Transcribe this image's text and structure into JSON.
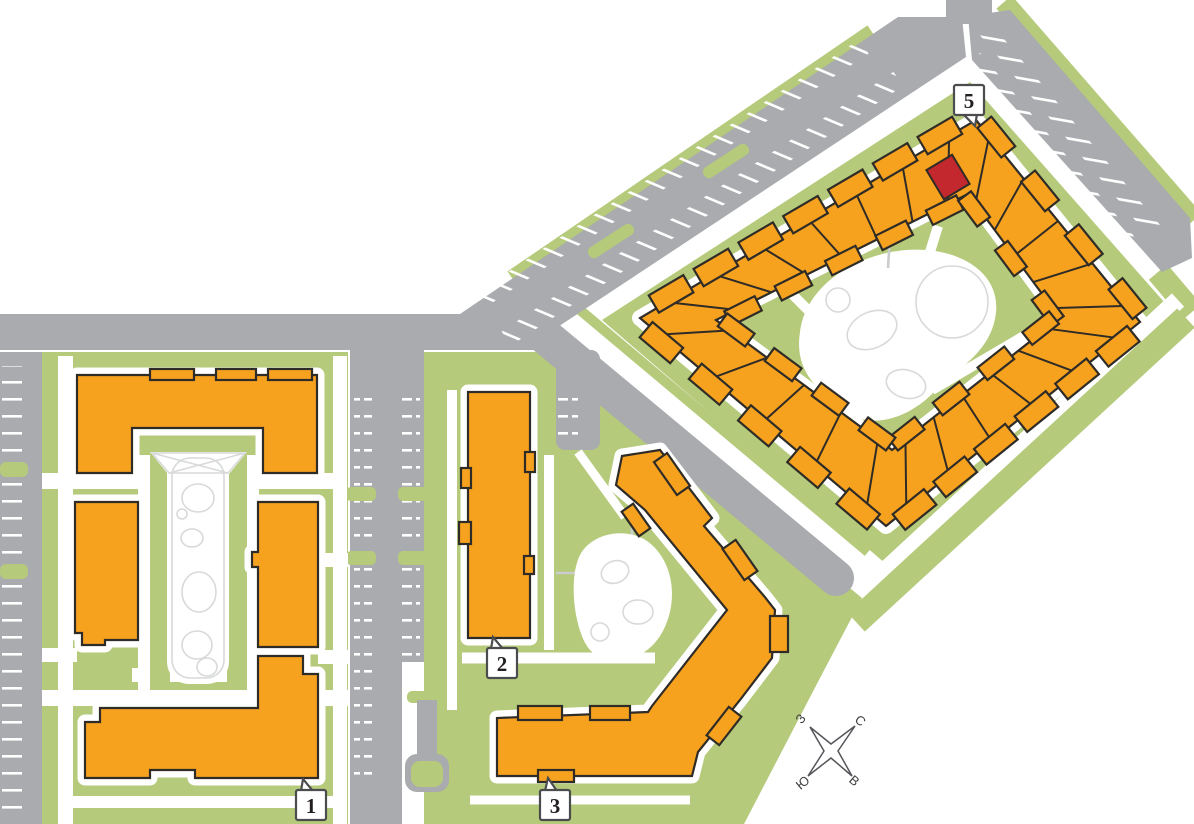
{
  "map": {
    "kind": "residential-complex-site-plan"
  },
  "buildings": {
    "b1": {
      "label": "1"
    },
    "b2": {
      "label": "2"
    },
    "b3": {
      "label": "3"
    },
    "b5": {
      "label": "5"
    }
  },
  "highlighted_unit": {
    "present": true,
    "color": "#c2282e"
  },
  "compass": {
    "north_label": "С",
    "east_label": "В",
    "south_label": "Ю",
    "west_label": "З"
  },
  "colors": {
    "background": "#ffffff",
    "building": "#f6a21f",
    "building_outline": "#2f2b26",
    "selected_unit": "#c2282e",
    "greenery": "#b5ca7a",
    "road": "#a9abae",
    "playground_outline": "#d8d9da",
    "label_border": "#4b4c4e",
    "label_text": "#231f20"
  }
}
